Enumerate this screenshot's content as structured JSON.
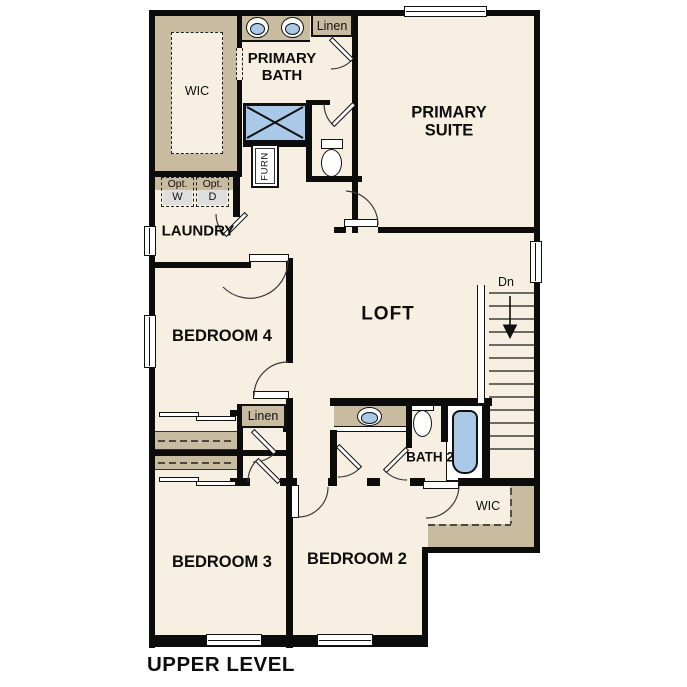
{
  "labels": {
    "title": "UPPER LEVEL",
    "primary_wic": "WIC",
    "primary_bath": "PRIMARY BATH",
    "linen_upper": "Linen",
    "furnace": "FURN",
    "primary_suite": "PRIMARY SUITE",
    "laundry": "LAUNDRY",
    "opt_washer_top": "Opt.",
    "opt_washer": "W",
    "opt_dryer_top": "Opt.",
    "opt_dryer": "D",
    "bedroom4": "BEDROOM 4",
    "loft": "LOFT",
    "stairs_down": "Dn",
    "linen_hall": "Linen",
    "bath2": "BATH 2",
    "bedroom2_wic": "WIC",
    "bedroom3": "BEDROOM 3",
    "bedroom2": "BEDROOM 2"
  },
  "colors": {
    "floor": "#f7efe2",
    "casework_tan": "#c9bb9f",
    "appliance_gray": "#dedede",
    "fixture_blue": "#aac9e8",
    "wall_black": "#0c0c0c"
  }
}
